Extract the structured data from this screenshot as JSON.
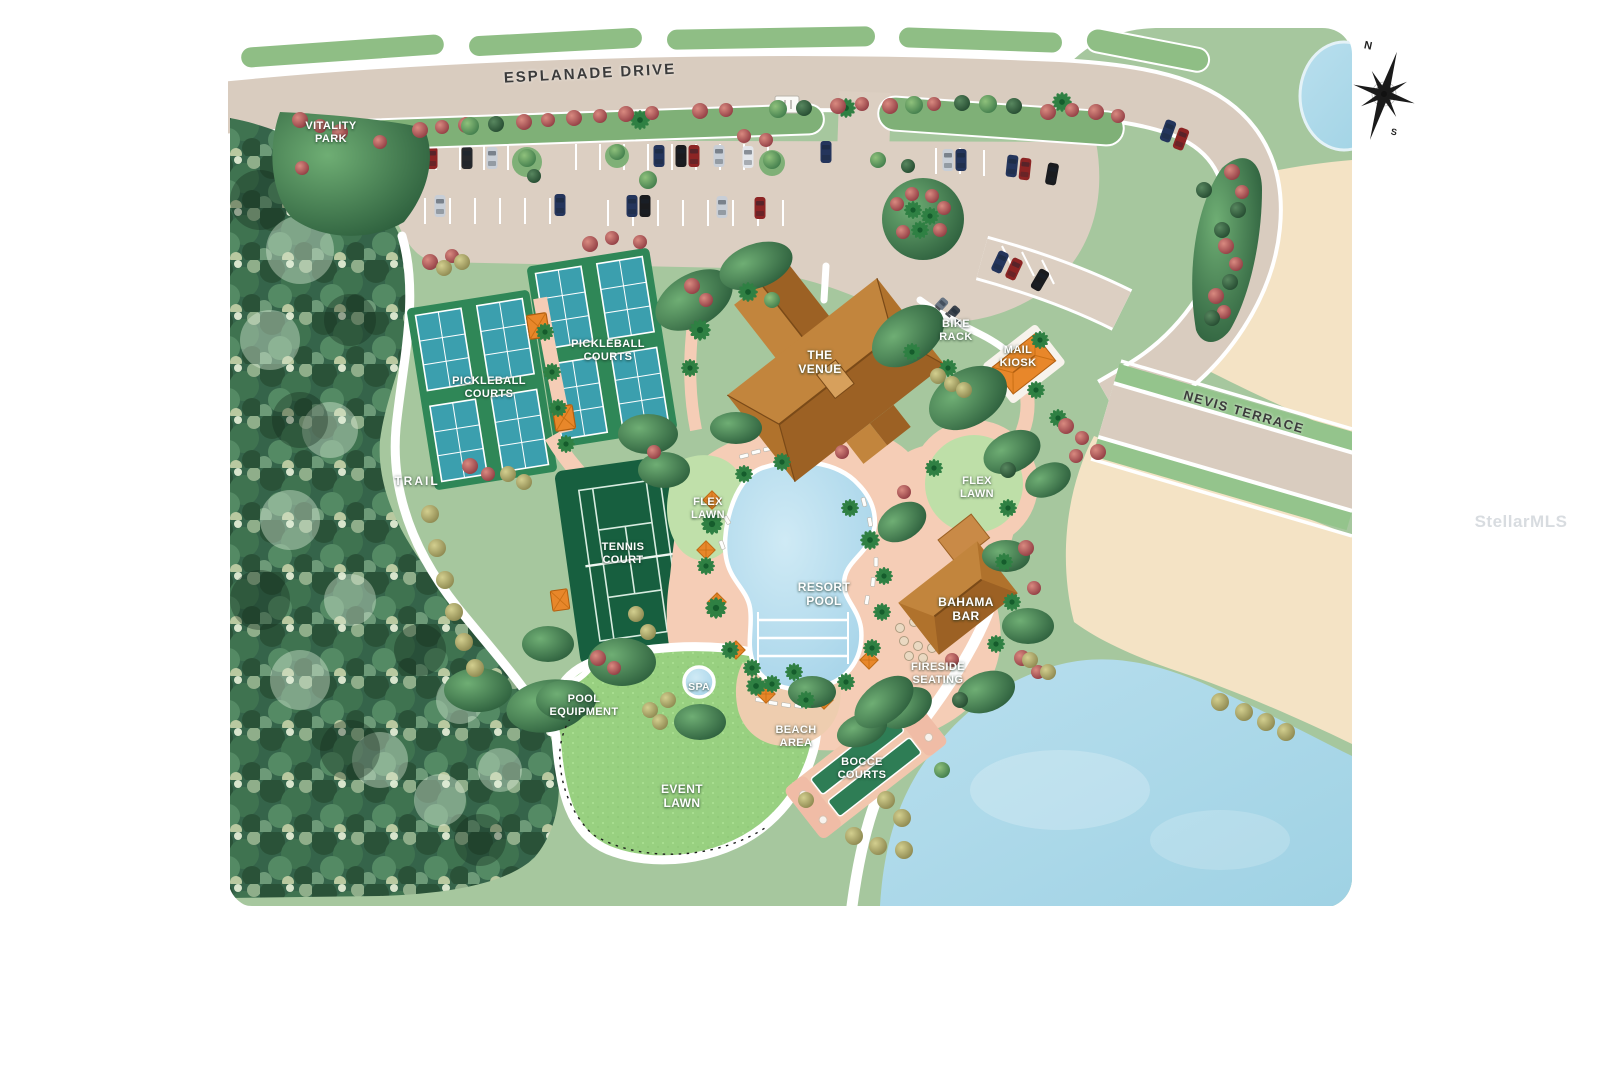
{
  "page": {
    "watermark": "StellarMLS"
  },
  "site_plan": {
    "roads": {
      "esplanade_drive": "ESPLANADE DRIVE",
      "nevis_terrace": "NEVIS TERRACE"
    },
    "labels": {
      "vitality_park": "VITALITY PARK",
      "trail": "TRAIL",
      "pickleball_courts_west": "PICKLEBALL COURTS",
      "pickleball_courts_east": "PICKLEBALL COURTS",
      "tennis_court": "TENNIS COURT",
      "the_venue": "THE VENUE",
      "bike_rack": "BIKE RACK",
      "mail_kiosk": "MAIL KIOSK",
      "flex_lawn_west": "FLEX LAWN",
      "flex_lawn_east": "FLEX LAWN",
      "resort_pool": "RESORT POOL",
      "bahama_bar": "BAHAMA BAR",
      "fireside_seating": "FIRESIDE SEATING",
      "spa": "SPA",
      "pool_equipment": "POOL EQUIPMENT",
      "beach_area": "BEACH AREA",
      "bocce_courts": "BOCCE COURTS",
      "event_lawn": "EVENT LAWN"
    },
    "compass": {
      "north": "N",
      "south": "S"
    },
    "colors": {
      "base_green": "#a6c79e",
      "forest_green": "#35644a",
      "road_beige": "#d9ccbf",
      "median_green": "#8fbe85",
      "water_blue": "#a9d8e8",
      "deck_salmon": "#f5cdb6",
      "building_brown": "#b0722c",
      "kiosk_orange": "#e8872a",
      "pickleball_teal": "#3b9fae",
      "court_green": "#1d6b47",
      "event_lawn_green": "#98d080",
      "sand_tan": "#f4e3c5"
    }
  }
}
